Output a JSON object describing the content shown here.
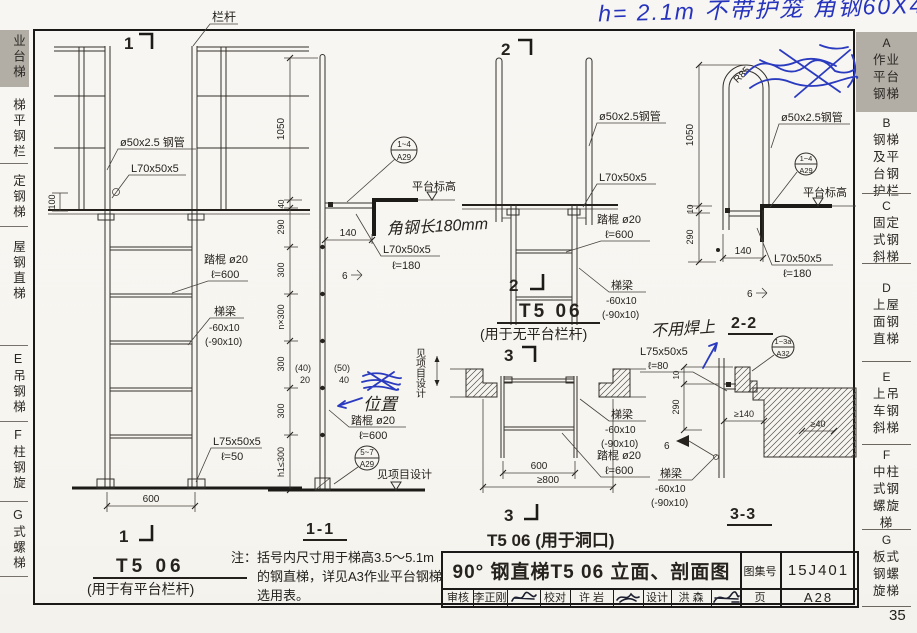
{
  "handwriting": {
    "top_note": "h= 2.1m 不带护笼 角钢60X40",
    "angle_length_note": "角钢长180mm",
    "crossed_out_note": "位置",
    "no_weld_note": "不用焊上"
  },
  "left_tabs": {
    "a": "业台梯",
    "b": "梯平钢栏",
    "c": "定钢梯",
    "d": "屋钢直梯",
    "e": "E吊钢梯",
    "f": "F柱钢旋",
    "g": "G式螺梯"
  },
  "right_tabs": {
    "a": {
      "letter": "A",
      "lines": [
        "作业",
        "平台",
        "钢梯"
      ]
    },
    "b": {
      "letter": "B",
      "lines": [
        "钢梯",
        "及平",
        "台钢",
        "护栏"
      ]
    },
    "c": {
      "letter": "C",
      "lines": [
        "固定",
        "式钢",
        "斜梯"
      ]
    },
    "d": {
      "letter": "D",
      "lines": [
        "上屋",
        "面钢",
        "直梯"
      ]
    },
    "e": {
      "letter": "E",
      "lines": [
        "上吊",
        "车钢",
        "斜梯"
      ]
    },
    "f": {
      "letter": "F",
      "lines": [
        "中柱",
        "式钢",
        "螺旋",
        "梯"
      ]
    },
    "g": {
      "letter": "G",
      "lines": [
        "板式",
        "钢螺",
        "旋梯"
      ]
    }
  },
  "elevation1": {
    "section_mark": "1",
    "railing": "栏杆",
    "pipe": "ø50x2.5 钢管",
    "angle": "L70x50x5",
    "dim_100": "100",
    "rung": "踏棍 ø20",
    "rung_len": "ℓ=600",
    "beam": "梯梁",
    "beam_size": "-60x10",
    "beam_size_alt": "(-90x10)",
    "foot_angle": "L75x50x5",
    "foot_len": "ℓ=50",
    "dim_600": "600",
    "title": "T5 06",
    "subtitle": "(用于有平台栏杆)"
  },
  "section11": {
    "title": "1-1",
    "dims": {
      "d1050": "1050",
      "d40": "40",
      "d290": "290",
      "d300a": "300",
      "dn300": "n×300",
      "d300b": "300",
      "d300c": "300",
      "dh1": "h1≤300"
    },
    "bubble_top": "1~4",
    "bubble_bottom": "A29",
    "platform_level": "平台标高",
    "dim_140": "140",
    "angle": "L70x50x5",
    "angle_len": "ℓ=180",
    "weld": "6",
    "off1a": "(40)",
    "off1b": "20",
    "off2a": "(50)",
    "off2b": "40",
    "rung": "踏棍 ø20",
    "rung_len": "ℓ=600",
    "bubble2_top": "5~7",
    "bubble2_bottom": "A29",
    "see_design_v": "见项目设计",
    "see_design": "见项目设计"
  },
  "note": {
    "line1": "注：括号内尺寸用于梯高3.5～5.1m",
    "line2": "的钢直梯，详见A3作业平台钢梯",
    "line3": "选用表。"
  },
  "elevation2": {
    "section_mark": "2",
    "pipe": "ø50x2.5钢管",
    "angle": "L70x50x5",
    "rung": "踏棍 ø20",
    "rung_len": "ℓ=600",
    "beam": "梯梁",
    "beam_size": "-60x10",
    "beam_size_alt": "(-90x10)",
    "title": "T5 06",
    "subtitle": "(用于无平台栏杆)"
  },
  "plan3": {
    "section_mark": "3",
    "beam": "梯梁",
    "beam_size": "-60x10",
    "beam_size_alt": "(-90x10)",
    "rung": "踏棍 ø20",
    "rung_len": "ℓ=600",
    "dim_600": "600",
    "dim_800": "≥800",
    "title": "T5 06 (用于洞口)"
  },
  "section22": {
    "title": "2-2",
    "r85": "R85",
    "pipe": "ø50x2.5钢管",
    "bubble_top": "1~4",
    "bubble_bottom": "A29",
    "platform_level": "平台标高",
    "dim_1050": "1050",
    "dim_10": "10",
    "dim_290": "290",
    "dim_140": "140",
    "angle": "L70x50x5",
    "angle_len": "ℓ=180",
    "weld": "6"
  },
  "section33": {
    "title": "3-3",
    "angle": "L75x50x5",
    "angle_len": "ℓ=80",
    "dim_10": "10",
    "dim_290": "290",
    "dim_140": "≥140",
    "dim_40": "≥40",
    "weld": "6",
    "beam": "梯梁",
    "beam_size": "-60x10",
    "beam_size_alt": "(-90x10)",
    "bubble_top": "1~3a",
    "bubble_bottom": "A32"
  },
  "titleblock": {
    "title": "90° 钢直梯T5 06 立面、剖面图",
    "atlas_label": "图集号",
    "atlas_no": "15J401",
    "page_label": "页",
    "page_no": "A28",
    "review_label": "审核",
    "reviewer": "李正刚",
    "proof_label": "校对",
    "proofer": "许 岩",
    "design_label": "设计",
    "designer": "洪 森"
  },
  "page_number": "35"
}
